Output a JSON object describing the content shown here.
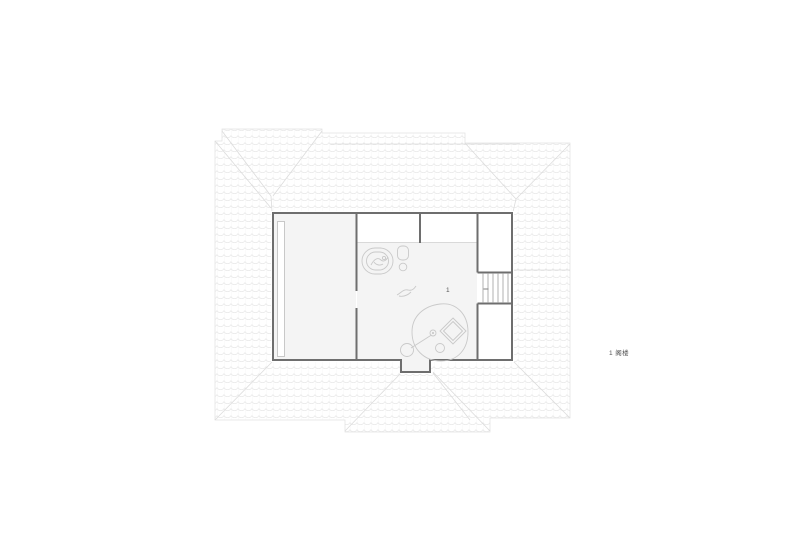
{
  "legend": {
    "label": "1 阁楼"
  },
  "plan": {
    "room_number": "1"
  },
  "colors": {
    "wall": "#6e6e6e",
    "furniture": "#c9c9c9",
    "room-fill": "#f4f4f4",
    "roof-tile": "#e9e9e9",
    "roof-line": "#dcdcdc",
    "roof-outline": "#e3e3e3",
    "stair": "#9e9e9e",
    "label-text": "#555555",
    "thin-line": "#d9d9d9",
    "background": "#ffffff"
  }
}
